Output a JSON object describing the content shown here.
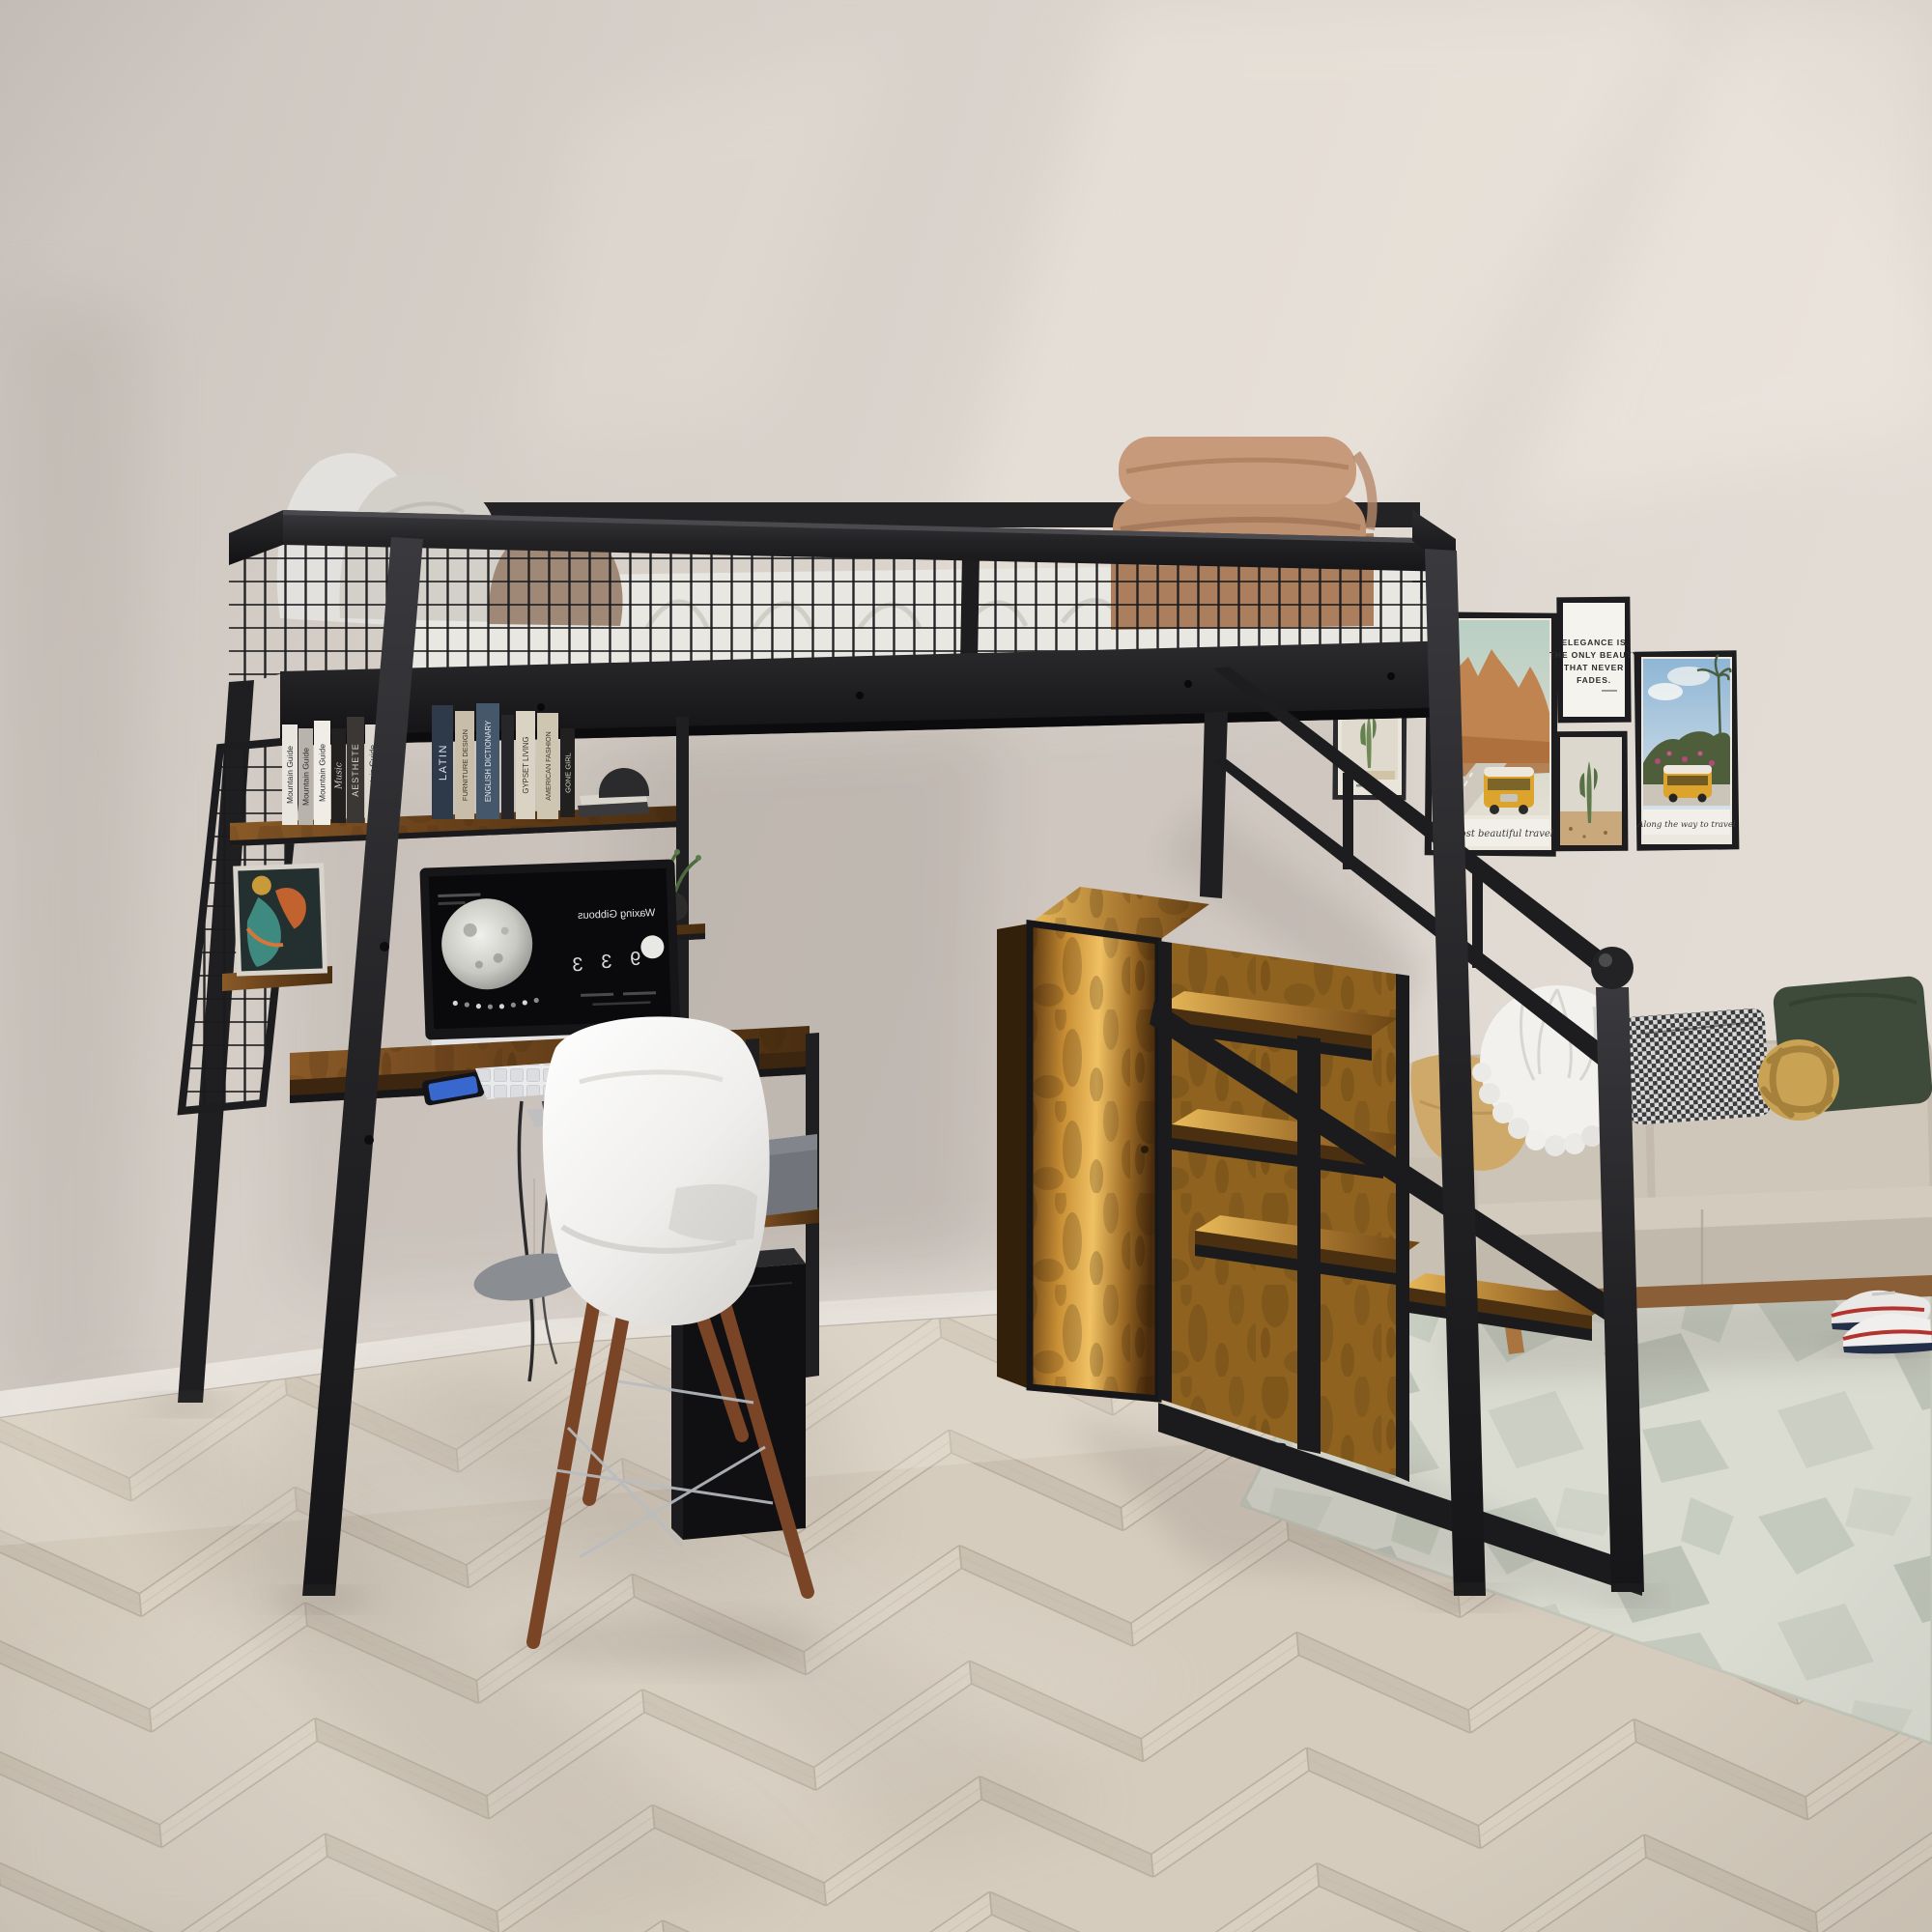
{
  "room": {
    "colors": {
      "wall": "#d8d1ca",
      "floor_wood": "#d4cabb",
      "metal_frame": "#232326",
      "rustic_wood": "#9c6a2b",
      "sofa": "#c8bfb3",
      "blanket": "#bd9070",
      "rug": "#d8dad0",
      "chair_shell": "#f4f3f1",
      "chair_legs": "#7a4526",
      "sneaker_accent_red": "#b3342f",
      "sneaker_accent_navy": "#24304a"
    }
  },
  "bookshelf": {
    "left_books": [
      {
        "title": "Mountain Guide",
        "color": "#e9e6e0",
        "text": "#2b2b2b"
      },
      {
        "title": "Mountain Guide",
        "color": "#b8b3ab",
        "text": "#2b2b2b"
      },
      {
        "title": "Mountain Guide",
        "color": "#f0ede7",
        "text": "#2b2b2b"
      },
      {
        "title": "Music",
        "color": "#232120",
        "text": "#d8d4cc"
      },
      {
        "title": "AESTHETE",
        "color": "#3a3734",
        "text": "#d8d4cc"
      },
      {
        "title": "Mountain Guide",
        "color": "#dcd8d0",
        "text": "#2b2b2b"
      },
      {
        "title": "Interior design",
        "color": "#1e1d1b",
        "text": "#e6e2da"
      }
    ],
    "right_books": [
      {
        "title": "LATIN",
        "color": "#2e3a4a",
        "text": "#dde1e6"
      },
      {
        "title": "FURNITURE DESIGN",
        "color": "#c8bda9",
        "text": "#3a3226"
      },
      {
        "title": "ENGLISH DICTIONARY",
        "color": "#45586b",
        "text": "#e6eaee"
      },
      {
        "title": "GYPSET LIVING",
        "color": "#dad3c3",
        "text": "#3a3226"
      },
      {
        "title": "AMERICAN FASHION",
        "color": "#cfc6b2",
        "text": "#3a3226"
      },
      {
        "title": "GONE GIRL",
        "color": "#21201e",
        "text": "#d8d4cc"
      }
    ]
  },
  "gallery": {
    "quote_lines": [
      "ELEGANCE IS",
      "THE ONLY BEAUTY",
      "THAT NEVER",
      "FADES."
    ],
    "canyon_caption": "The most beautiful travel",
    "bus_caption": "Along the way to travel"
  },
  "monitor": {
    "phase": "Waxing Gibbous",
    "stats": [
      "3",
      "3",
      "9"
    ]
  }
}
